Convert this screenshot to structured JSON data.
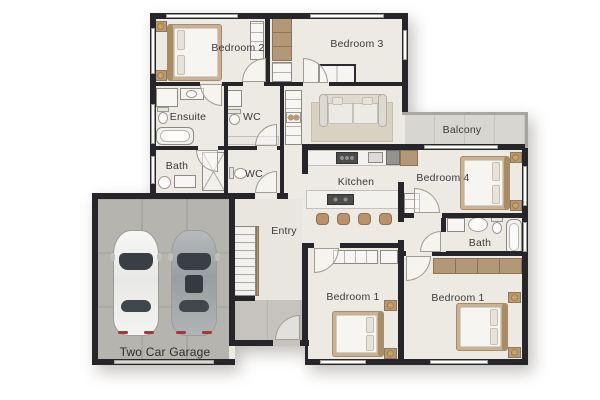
{
  "rooms": {
    "bedroom2": {
      "label": "Bedroom 2"
    },
    "bedroom3": {
      "label": "Bedroom 3"
    },
    "ensuite": {
      "label": "Ensuite"
    },
    "wc_upper": {
      "label": "WC"
    },
    "bath_left": {
      "label": "Bath"
    },
    "wc_lower": {
      "label": "WC"
    },
    "balcony": {
      "label": "Balcony"
    },
    "kitchen": {
      "label": "Kitchen"
    },
    "bedroom4": {
      "label": "Bedroom 4"
    },
    "entry": {
      "label": "Entry"
    },
    "bath_right": {
      "label": "Bath"
    },
    "bedroom1_left": {
      "label": "Bedroom 1"
    },
    "bedroom1_right": {
      "label": "Bedroom 1"
    },
    "garage": {
      "label": "Two Car Garage"
    }
  },
  "colors": {
    "floor": "#edeae3",
    "garage_floor": "#b6b4af",
    "porch_floor": "#c6c3be",
    "balcony_floor": "#d8d6d1",
    "wall": "#26262a",
    "wood": "#b39878",
    "lamp_gold": "#c9a366"
  }
}
